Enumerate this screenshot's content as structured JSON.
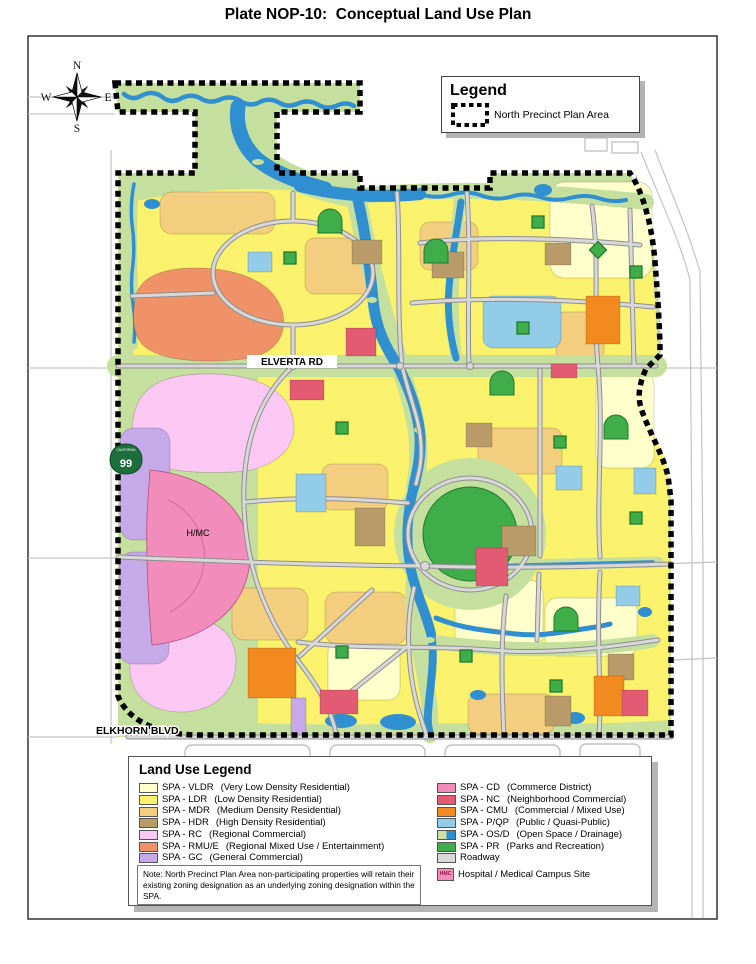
{
  "page": {
    "title": "Plate NOP-10:  Conceptual Land Use Plan"
  },
  "compass": {
    "north": "N",
    "south": "S",
    "east": "E",
    "west": "W"
  },
  "map_legend": {
    "title": "Legend",
    "boundary_label": "North Precinct Plan Area"
  },
  "map_labels": {
    "elverta_rd": "ELVERTA RD",
    "elkhorn_blvd": "ELKHORN BLVD",
    "hmc": "H/MC",
    "highway_shield": "99",
    "highway_state": "CALIFORNIA"
  },
  "colors": {
    "greenbelt": "#C5DF9E",
    "water": "#2F8FD0",
    "road-casing": "#8F8F8F",
    "road-fill": "#D8D8D8",
    "boundary": "#000000",
    "shield": "#1C6E3C"
  },
  "land_use_legend": {
    "title": "Land Use Legend",
    "left_column": [
      {
        "code": "SPA - VLDR",
        "desc": "(Very Low Density Residential)",
        "color": "#FFFFCC"
      },
      {
        "code": "SPA - LDR",
        "desc": "(Low Density Residential)",
        "color": "#FAF26C"
      },
      {
        "code": "SPA - MDR",
        "desc": "(Medium Density Residential)",
        "color": "#F3CE7E"
      },
      {
        "code": "SPA - HDR",
        "desc": "(High Density Residential)",
        "color": "#B89B69"
      },
      {
        "code": "SPA - RC",
        "desc": "(Regional Commercial)",
        "color": "#FBC8F4"
      },
      {
        "code": "SPA - RMU/E",
        "desc": "(Regional Mixed Use / Entertainment)",
        "color": "#EF9268"
      },
      {
        "code": "SPA - GC",
        "desc": "(General Commercial)",
        "color": "#C6A9E9"
      }
    ],
    "right_column": [
      {
        "code": "SPA - CD",
        "desc": "(Commerce District)",
        "color": "#F28CBA"
      },
      {
        "code": "SPA - NC",
        "desc": "(Neighborhood Commercial)",
        "color": "#E25B73"
      },
      {
        "code": "SPA - CMU",
        "desc": "(Commercial / Mixed Use)",
        "color": "#F28A1F"
      },
      {
        "code": "SPA - P/QP",
        "desc": "(Public / Quasi-Public)",
        "color": "#92CCE8"
      },
      {
        "code": "SPA - OS/D",
        "desc": "(Open Space / Drainage)",
        "color": "#C9E2A4",
        "color2": "#2F8FD0"
      },
      {
        "code": "SPA - PR",
        "desc": "(Parks and Recreation)",
        "color": "#3FAD49"
      },
      {
        "code": "Roadway",
        "desc": "",
        "color": "#D9D9D9"
      },
      {
        "code": "Hospital / Medical Campus Site",
        "desc": "",
        "color": "#F28CBA",
        "swatch_text": "HMC"
      }
    ],
    "note": "Note: North Precinct Plan Area non-participating properties will retain their existing zoning designation as an underlying zoning designation within the SPA."
  }
}
